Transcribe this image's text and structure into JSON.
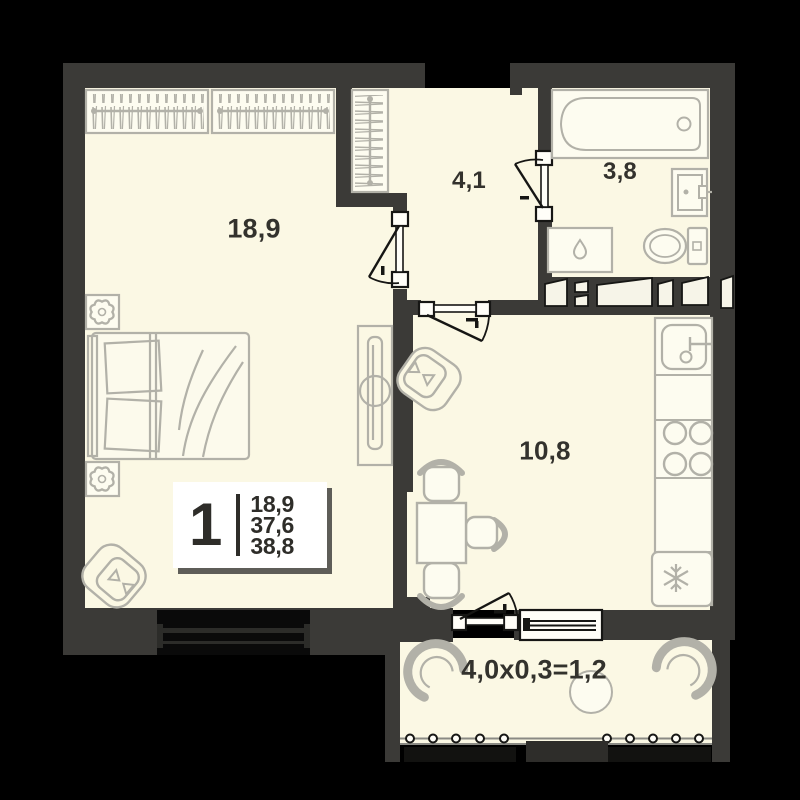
{
  "plan": {
    "title": "1-room apartment floor plan",
    "legend": {
      "rooms_count": "1",
      "living_area": "18,9",
      "area_no_balcony": "37,6",
      "total_area": "38,8"
    },
    "rooms": [
      {
        "id": "bedroom",
        "label": "18,9"
      },
      {
        "id": "hallway",
        "label": "4,1"
      },
      {
        "id": "bathroom",
        "label": "3,8"
      },
      {
        "id": "kitchen",
        "label": "10,8"
      },
      {
        "id": "balcony",
        "label": "4,0x0,3=1,2"
      }
    ],
    "icons": [
      "wardrobe-icon",
      "bed-icon",
      "plant-icon",
      "armchair-icon",
      "tv-stand-icon",
      "bathtub-icon",
      "sink-icon",
      "toilet-icon",
      "washing-machine-icon",
      "kitchen-sink-icon",
      "stove-icon",
      "fridge-snowflake-icon",
      "dining-table-icon",
      "balcony-chair-icon",
      "balcony-table-icon",
      "door-icon",
      "window-icon",
      "railing-icon"
    ],
    "colors": {
      "background": "#000000",
      "wall": "#3b3a37",
      "floor": "#fbf8e4",
      "furniture": "#b2b1a8",
      "door_line": "#161614",
      "legend_bg": "#ffffff",
      "text": "#33322d"
    }
  }
}
